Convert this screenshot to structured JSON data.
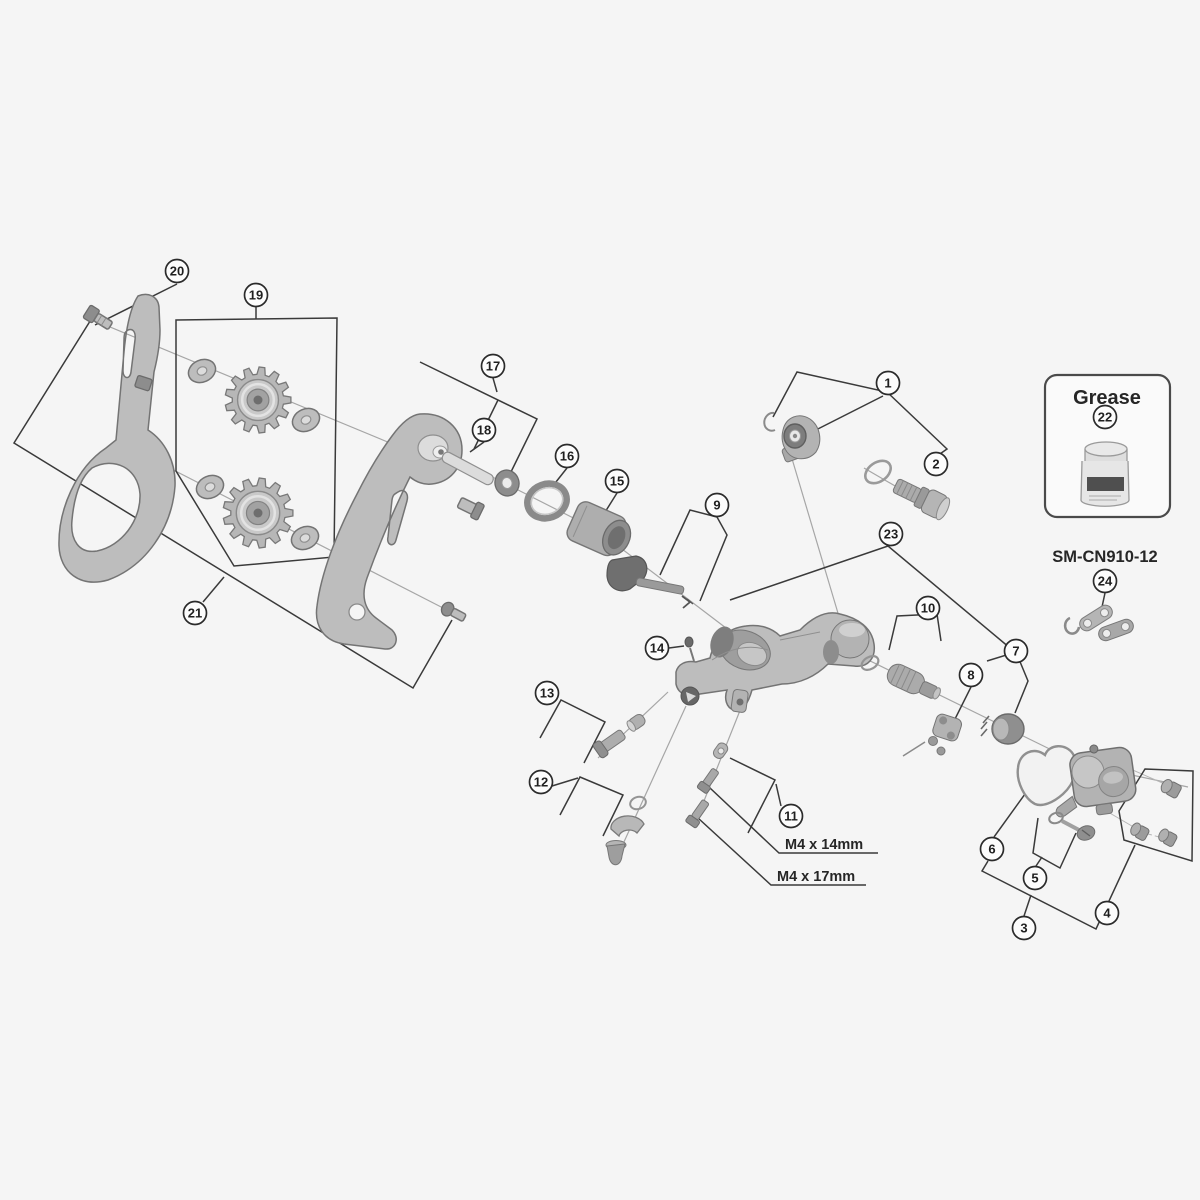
{
  "labels": {
    "grease": "Grease",
    "chain_code": "SM-CN910-12",
    "m4_14": "M4 x 14mm",
    "m4_17": "M4 x 17mm"
  },
  "colors": {
    "background": "#f5f5f5",
    "line": "#3a3a3a",
    "part_fill": "#bdbdbd",
    "part_stroke": "#747474",
    "text": "#262626"
  },
  "callouts": [
    {
      "n": "1",
      "x": 888,
      "y": 383
    },
    {
      "n": "2",
      "x": 936,
      "y": 464
    },
    {
      "n": "3",
      "x": 1024,
      "y": 928
    },
    {
      "n": "4",
      "x": 1107,
      "y": 913
    },
    {
      "n": "5",
      "x": 1035,
      "y": 878
    },
    {
      "n": "6",
      "x": 992,
      "y": 849
    },
    {
      "n": "7",
      "x": 1016,
      "y": 651
    },
    {
      "n": "8",
      "x": 971,
      "y": 675
    },
    {
      "n": "9",
      "x": 717,
      "y": 505
    },
    {
      "n": "10",
      "x": 928,
      "y": 608
    },
    {
      "n": "11",
      "x": 791,
      "y": 816
    },
    {
      "n": "12",
      "x": 541,
      "y": 782
    },
    {
      "n": "13",
      "x": 547,
      "y": 693
    },
    {
      "n": "14",
      "x": 657,
      "y": 648
    },
    {
      "n": "15",
      "x": 617,
      "y": 481
    },
    {
      "n": "16",
      "x": 567,
      "y": 456
    },
    {
      "n": "17",
      "x": 493,
      "y": 366
    },
    {
      "n": "18",
      "x": 484,
      "y": 430
    },
    {
      "n": "19",
      "x": 256,
      "y": 295
    },
    {
      "n": "20",
      "x": 177,
      "y": 271
    },
    {
      "n": "21",
      "x": 195,
      "y": 613
    },
    {
      "n": "22",
      "x": 1105,
      "y": 417
    },
    {
      "n": "23",
      "x": 891,
      "y": 534
    },
    {
      "n": "24",
      "x": 1105,
      "y": 581
    }
  ],
  "pulleys": [
    {
      "cx": 258,
      "cy": 400,
      "teeth": 13,
      "r": 33
    },
    {
      "cx": 258,
      "cy": 513,
      "teeth": 13,
      "r": 35
    }
  ]
}
